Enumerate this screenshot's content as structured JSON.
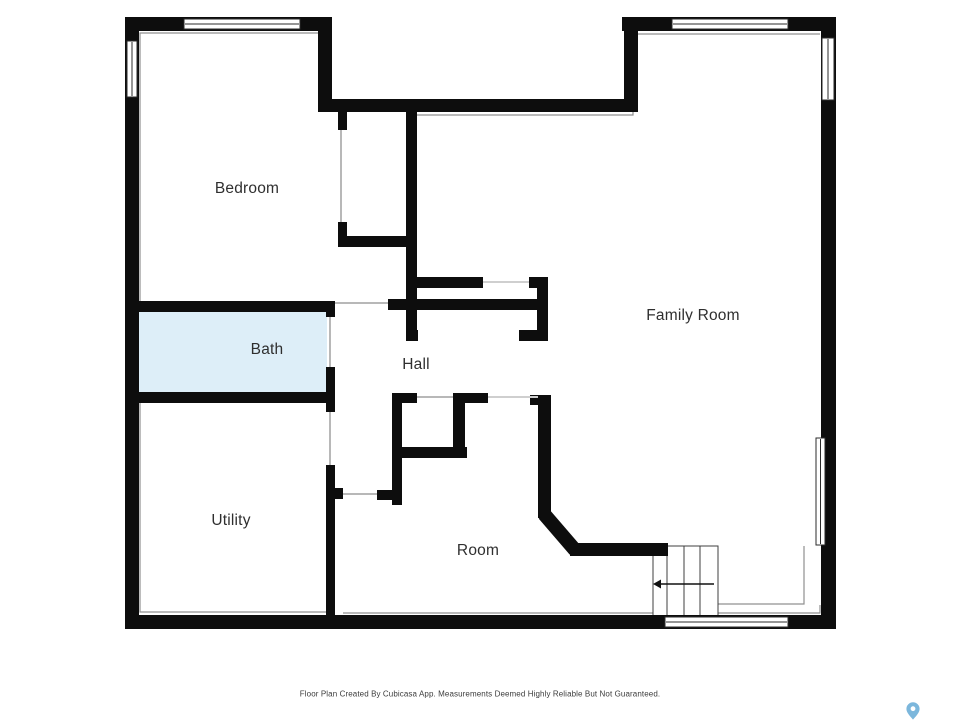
{
  "footer": {
    "text": "Floor Plan Created By Cubicasa App. Measurements Deemed Highly Reliable But Not Guaranteed."
  },
  "palette": {
    "wall": "#0d0d0d",
    "thin_line": "#909090",
    "door_line": "#b8b8b8",
    "opening_line": "#cfcfcf",
    "bath_fill": "#ddeef8",
    "stair_line": "#3f3f3f",
    "arrow": "#111111",
    "label": "#2f2f2f",
    "pin": "#7cb7dc"
  },
  "floor_plan": {
    "rooms": [
      {
        "name": "Bedroom",
        "x": 247,
        "y": 189
      },
      {
        "name": "Bath",
        "x": 267,
        "y": 350
      },
      {
        "name": "Hall",
        "x": 416,
        "y": 365
      },
      {
        "name": "Family Room",
        "x": 693,
        "y": 316
      },
      {
        "name": "Utility",
        "x": 231,
        "y": 521
      },
      {
        "name": "Room",
        "x": 478,
        "y": 551
      }
    ],
    "bath_area": {
      "x": 135,
      "y": 306,
      "w": 192,
      "h": 92
    },
    "walls": [
      {
        "name": "top-wall-west",
        "x": 125,
        "y": 17,
        "w": 207,
        "h": 14
      },
      {
        "name": "west-wall",
        "x": 125,
        "y": 17,
        "w": 14,
        "h": 612
      },
      {
        "name": "bedroom-east-upper",
        "x": 318,
        "y": 17,
        "w": 14,
        "h": 95
      },
      {
        "name": "recessed-top-wall",
        "x": 318,
        "y": 99,
        "w": 320,
        "h": 13
      },
      {
        "name": "family-west-upper",
        "x": 624,
        "y": 17,
        "w": 14,
        "h": 95
      },
      {
        "name": "top-wall-east",
        "x": 622,
        "y": 17,
        "w": 214,
        "h": 14
      },
      {
        "name": "east-wall",
        "x": 821,
        "y": 17,
        "w": 15,
        "h": 612
      },
      {
        "name": "south-wall",
        "x": 125,
        "y": 615,
        "w": 711,
        "h": 14
      },
      {
        "name": "closet-west-jamb-north",
        "x": 338,
        "y": 112,
        "w": 9,
        "h": 18
      },
      {
        "name": "closet-west-jamb-south",
        "x": 338,
        "y": 222,
        "w": 9,
        "h": 25
      },
      {
        "name": "closet-south-wall",
        "x": 338,
        "y": 236,
        "w": 78,
        "h": 11
      },
      {
        "name": "hall-family-divider",
        "x": 406,
        "y": 112,
        "w": 11,
        "h": 229
      },
      {
        "name": "divider-foot-stub",
        "x": 406,
        "y": 330,
        "w": 12,
        "h": 11
      },
      {
        "name": "hall-north-wall",
        "x": 412,
        "y": 277,
        "w": 71,
        "h": 11
      },
      {
        "name": "family-entry-jamb-top",
        "x": 529,
        "y": 277,
        "w": 19,
        "h": 11
      },
      {
        "name": "family-entry-jamb-east",
        "x": 537,
        "y": 277,
        "w": 11,
        "h": 64
      },
      {
        "name": "family-entry-jamb-south",
        "x": 519,
        "y": 330,
        "w": 29,
        "h": 11
      },
      {
        "name": "hall-south-wall",
        "x": 388,
        "y": 299,
        "w": 157,
        "h": 11
      },
      {
        "name": "bath-north-wall",
        "x": 125,
        "y": 301,
        "w": 210,
        "h": 11
      },
      {
        "name": "bath-door-jamb-north",
        "x": 326,
        "y": 301,
        "w": 9,
        "h": 16
      },
      {
        "name": "bath-east-wall",
        "x": 326,
        "y": 367,
        "w": 9,
        "h": 45
      },
      {
        "name": "bath-south-wall",
        "x": 125,
        "y": 392,
        "w": 210,
        "h": 11
      },
      {
        "name": "utility-east-wall",
        "x": 326,
        "y": 465,
        "w": 9,
        "h": 164
      },
      {
        "name": "utility-door-jamb",
        "x": 326,
        "y": 488,
        "w": 17,
        "h": 11
      },
      {
        "name": "corridor-west-wall",
        "x": 392,
        "y": 393,
        "w": 10,
        "h": 112
      },
      {
        "name": "corridor-north-stub",
        "x": 392,
        "y": 393,
        "w": 25,
        "h": 10
      },
      {
        "name": "corridor-south-stub",
        "x": 377,
        "y": 490,
        "w": 25,
        "h": 10
      },
      {
        "name": "room-closet-north",
        "x": 453,
        "y": 393,
        "w": 35,
        "h": 10
      },
      {
        "name": "room-closet-east",
        "x": 453,
        "y": 393,
        "w": 12,
        "h": 60
      },
      {
        "name": "room-closet-south",
        "x": 402,
        "y": 447,
        "w": 65,
        "h": 11
      },
      {
        "name": "room-east-wall",
        "x": 538,
        "y": 395,
        "w": 13,
        "h": 123
      },
      {
        "name": "room-east-wall-cap",
        "x": 530,
        "y": 395,
        "w": 9,
        "h": 10
      },
      {
        "name": "stair-north-wall",
        "x": 570,
        "y": 543,
        "w": 98,
        "h": 13
      }
    ],
    "diagonal_wall": {
      "x1": 544,
      "y1": 514,
      "x2": 575,
      "y2": 550,
      "thickness": 14
    },
    "windows": [
      {
        "name": "bedroom-north-window",
        "x": 184,
        "y": 19,
        "w": 116,
        "h": 10
      },
      {
        "name": "bedroom-west-window",
        "x": 127,
        "y": 41,
        "w": 10,
        "h": 56
      },
      {
        "name": "family-north-window",
        "x": 672,
        "y": 19,
        "w": 116,
        "h": 10
      },
      {
        "name": "family-east-window-upper",
        "x": 822,
        "y": 38,
        "w": 12,
        "h": 62
      },
      {
        "name": "family-east-window-lower",
        "x": 816,
        "y": 438,
        "w": 9,
        "h": 107
      },
      {
        "name": "family-south-window",
        "x": 665,
        "y": 617,
        "w": 123,
        "h": 10
      }
    ],
    "doors": [
      {
        "name": "closet-door",
        "x1": 341,
        "y1": 130,
        "x2": 341,
        "y2": 222
      },
      {
        "name": "bath-door",
        "x1": 330,
        "y1": 317,
        "x2": 330,
        "y2": 367
      },
      {
        "name": "utility-door",
        "x1": 330,
        "y1": 412,
        "x2": 330,
        "y2": 465
      },
      {
        "name": "corridor-south-door",
        "x1": 343,
        "y1": 494,
        "x2": 377,
        "y2": 494
      },
      {
        "name": "hall-corridor-door",
        "x1": 335,
        "y1": 303,
        "x2": 388,
        "y2": 303
      },
      {
        "name": "room-closet-door",
        "x1": 417,
        "y1": 397,
        "x2": 453,
        "y2": 397
      },
      {
        "name": "hall-room-opening",
        "x1": 488,
        "y1": 397,
        "x2": 538,
        "y2": 397
      },
      {
        "name": "hall-family-opening",
        "x1": 483,
        "y1": 282,
        "x2": 529,
        "y2": 282
      }
    ],
    "inner_outlines": [
      [
        [
          140,
          301
        ],
        [
          140,
          33
        ],
        [
          331,
          33
        ]
      ],
      [
        [
          416,
          115
        ],
        [
          633,
          115
        ],
        [
          633,
          34
        ],
        [
          820,
          34
        ]
      ],
      [
        [
          804,
          546
        ],
        [
          804,
          604
        ],
        [
          718,
          604
        ]
      ],
      [
        [
          718,
          613
        ],
        [
          820,
          613
        ],
        [
          820,
          605
        ]
      ],
      [
        [
          140,
          403
        ],
        [
          140,
          612
        ],
        [
          326,
          612
        ]
      ],
      [
        [
          343,
          613
        ],
        [
          653,
          613
        ]
      ]
    ],
    "stairs": {
      "x": 653,
      "y": 546,
      "w": 65,
      "h": 71,
      "treads_x": [
        667,
        684,
        700
      ],
      "arrow_y": 584,
      "arrow_from_x": 714,
      "arrow_to_x": 661
    }
  }
}
